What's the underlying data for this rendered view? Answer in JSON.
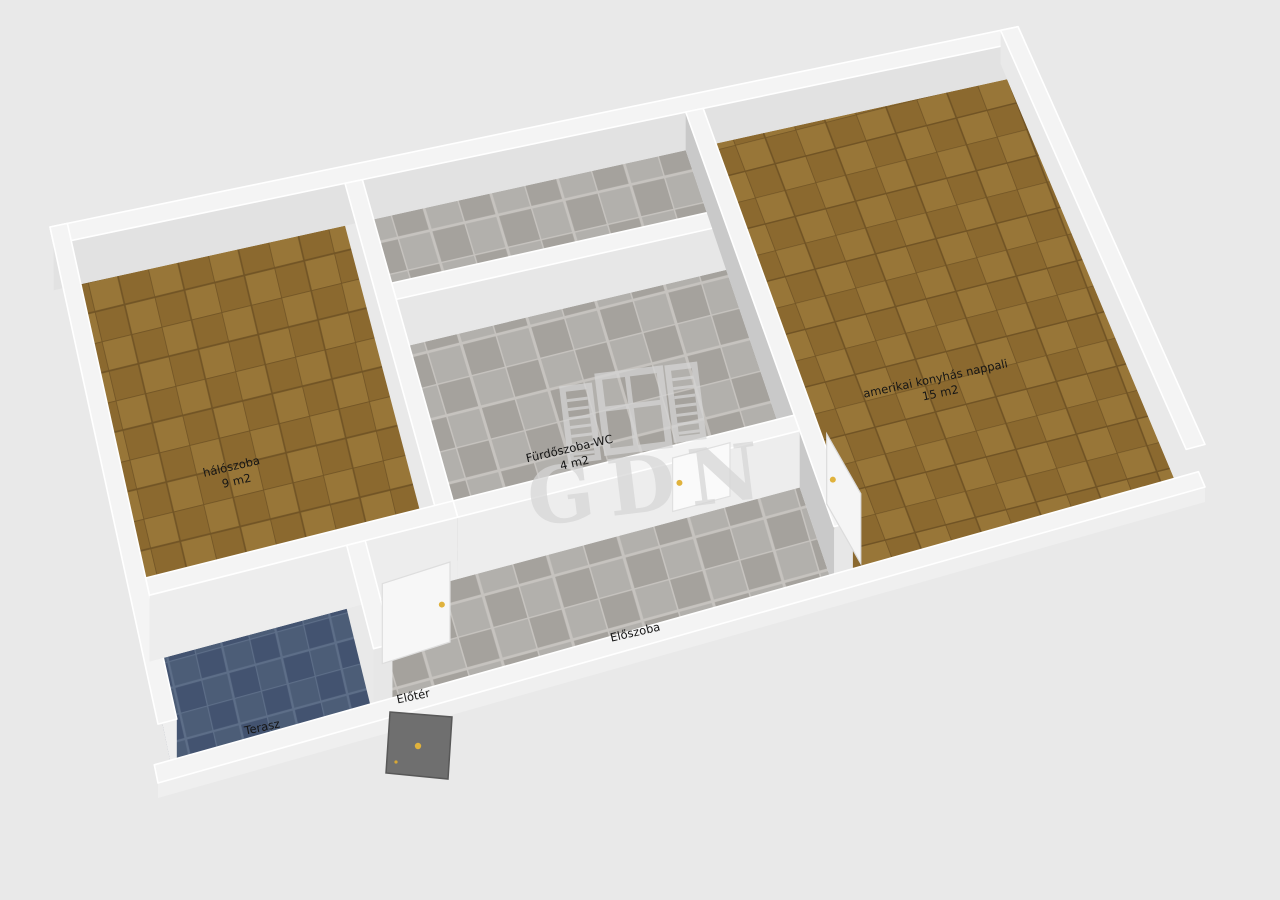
{
  "watermark": {
    "brand": "GDN"
  },
  "rooms": [
    {
      "id": "bedroom",
      "label": "hálószoba",
      "area": "9 m2",
      "floor": "parquet"
    },
    {
      "id": "bathroom",
      "label": "Fürdőszoba-WC",
      "area": "4 m2",
      "floor": "grey-tile"
    },
    {
      "id": "living-room",
      "label": "amerikai konyhás nappali",
      "area": "15 m2",
      "floor": "parquet"
    },
    {
      "id": "hallway",
      "label": "Előszoba",
      "area": "",
      "floor": "grey-tile"
    },
    {
      "id": "terrace",
      "label": "Terasz",
      "area": "",
      "floor": "blue-tile"
    },
    {
      "id": "foyer",
      "label": "Előtér",
      "area": "",
      "floor": "grey-tile"
    }
  ],
  "colors": {
    "background": "#e9e9e9",
    "wall_white": "#f4f4f4",
    "wall_grey_face": "#c9c9c9",
    "parquet_brown": "#8b692f",
    "tile_grey": "#b2b0ac",
    "terrace_blue": "#4c5d77",
    "entrance_door_grey": "#6f6f6f",
    "handle_yellow": "#e0b23c",
    "watermark_grey": "#d6d6d6",
    "label_text": "#151515"
  }
}
